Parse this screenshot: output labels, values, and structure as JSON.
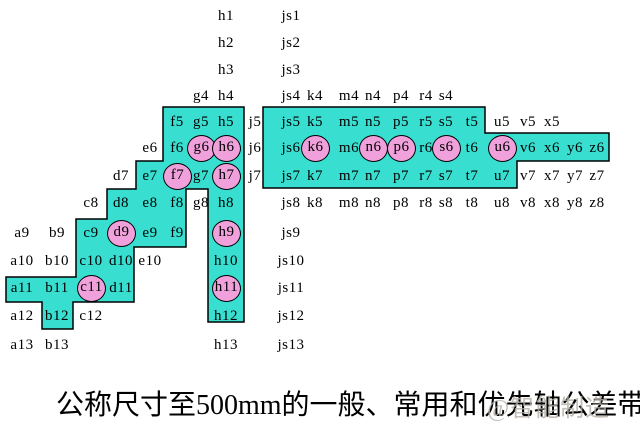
{
  "caption": {
    "text": "公称尺寸至500mm的一般、常用和优先轴公差带"
  },
  "watermark": {
    "text": "@智能制造"
  },
  "colors": {
    "background": "#ffffff",
    "common_fill": "#38dfd0",
    "preferred_fill": "#f0a0da",
    "outline": "#000000",
    "label_text": "#000000",
    "watermark_text": "#b3ada6"
  },
  "diagram": {
    "columns": [
      "a",
      "b",
      "c",
      "d",
      "e",
      "f",
      "g",
      "h",
      "j",
      "js",
      "k",
      "m",
      "n",
      "p",
      "r",
      "s",
      "t",
      "u",
      "v",
      "x",
      "y",
      "z"
    ],
    "row_grades": [
      1,
      2,
      3,
      4,
      5,
      6,
      7,
      8,
      9,
      10,
      11,
      12,
      13
    ],
    "status_legend": {
      "g": "general",
      "c": "common (cyan region)",
      "p": "preferred (circled)"
    },
    "cells": [
      [
        "h1",
        "h",
        1,
        "g"
      ],
      [
        "js1",
        "js",
        1,
        "g"
      ],
      [
        "h2",
        "h",
        2,
        "g"
      ],
      [
        "js2",
        "js",
        2,
        "g"
      ],
      [
        "h3",
        "h",
        3,
        "g"
      ],
      [
        "js3",
        "js",
        3,
        "g"
      ],
      [
        "g4",
        "g",
        4,
        "g"
      ],
      [
        "h4",
        "h",
        4,
        "g"
      ],
      [
        "js4",
        "js",
        4,
        "g"
      ],
      [
        "k4",
        "k",
        4,
        "g"
      ],
      [
        "m4",
        "m",
        4,
        "g"
      ],
      [
        "n4",
        "n",
        4,
        "g"
      ],
      [
        "p4",
        "p",
        4,
        "g"
      ],
      [
        "r4",
        "r",
        4,
        "g"
      ],
      [
        "s4",
        "s",
        4,
        "g"
      ],
      [
        "f5",
        "f",
        5,
        "c"
      ],
      [
        "g5",
        "g",
        5,
        "c"
      ],
      [
        "h5",
        "h",
        5,
        "c"
      ],
      [
        "j5",
        "j",
        5,
        "g"
      ],
      [
        "js5",
        "js",
        5,
        "c"
      ],
      [
        "k5",
        "k",
        5,
        "c"
      ],
      [
        "m5",
        "m",
        5,
        "c"
      ],
      [
        "n5",
        "n",
        5,
        "c"
      ],
      [
        "p5",
        "p",
        5,
        "c"
      ],
      [
        "r5",
        "r",
        5,
        "c"
      ],
      [
        "s5",
        "s",
        5,
        "c"
      ],
      [
        "t5",
        "t",
        5,
        "c"
      ],
      [
        "u5",
        "u",
        5,
        "g"
      ],
      [
        "v5",
        "v",
        5,
        "g"
      ],
      [
        "x5",
        "x",
        5,
        "g"
      ],
      [
        "e6",
        "e",
        6,
        "g"
      ],
      [
        "f6",
        "f",
        6,
        "c"
      ],
      [
        "g6",
        "g",
        6,
        "p"
      ],
      [
        "h6",
        "h",
        6,
        "p"
      ],
      [
        "j6",
        "j",
        6,
        "g"
      ],
      [
        "js6",
        "js",
        6,
        "c"
      ],
      [
        "k6",
        "k",
        6,
        "p"
      ],
      [
        "m6",
        "m",
        6,
        "c"
      ],
      [
        "n6",
        "n",
        6,
        "p"
      ],
      [
        "p6",
        "p",
        6,
        "p"
      ],
      [
        "r6",
        "r",
        6,
        "c"
      ],
      [
        "s6",
        "s",
        6,
        "p"
      ],
      [
        "t6",
        "t",
        6,
        "c"
      ],
      [
        "u6",
        "u",
        6,
        "p"
      ],
      [
        "v6",
        "v",
        6,
        "c"
      ],
      [
        "x6",
        "x",
        6,
        "c"
      ],
      [
        "y6",
        "y",
        6,
        "c"
      ],
      [
        "z6",
        "z",
        6,
        "c"
      ],
      [
        "d7",
        "d",
        7,
        "g"
      ],
      [
        "e7",
        "e",
        7,
        "c"
      ],
      [
        "f7",
        "f",
        7,
        "p"
      ],
      [
        "g7",
        "g",
        7,
        "c"
      ],
      [
        "h7",
        "h",
        7,
        "p"
      ],
      [
        "j7",
        "j",
        7,
        "g"
      ],
      [
        "js7",
        "js",
        7,
        "c"
      ],
      [
        "k7",
        "k",
        7,
        "c"
      ],
      [
        "m7",
        "m",
        7,
        "c"
      ],
      [
        "n7",
        "n",
        7,
        "c"
      ],
      [
        "p7",
        "p",
        7,
        "c"
      ],
      [
        "r7",
        "r",
        7,
        "c"
      ],
      [
        "s7",
        "s",
        7,
        "c"
      ],
      [
        "t7",
        "t",
        7,
        "c"
      ],
      [
        "u7",
        "u",
        7,
        "c"
      ],
      [
        "v7",
        "v",
        7,
        "g"
      ],
      [
        "x7",
        "x",
        7,
        "g"
      ],
      [
        "y7",
        "y",
        7,
        "g"
      ],
      [
        "z7",
        "z",
        7,
        "g"
      ],
      [
        "c8",
        "c",
        8,
        "g"
      ],
      [
        "d8",
        "d",
        8,
        "c"
      ],
      [
        "e8",
        "e",
        8,
        "c"
      ],
      [
        "f8",
        "f",
        8,
        "c"
      ],
      [
        "g8",
        "g",
        8,
        "g"
      ],
      [
        "h8",
        "h",
        8,
        "c"
      ],
      [
        "js8",
        "js",
        8,
        "g"
      ],
      [
        "k8",
        "k",
        8,
        "g"
      ],
      [
        "m8",
        "m",
        8,
        "g"
      ],
      [
        "n8",
        "n",
        8,
        "g"
      ],
      [
        "p8",
        "p",
        8,
        "g"
      ],
      [
        "r8",
        "r",
        8,
        "g"
      ],
      [
        "s8",
        "s",
        8,
        "g"
      ],
      [
        "t8",
        "t",
        8,
        "g"
      ],
      [
        "u8",
        "u",
        8,
        "g"
      ],
      [
        "v8",
        "v",
        8,
        "g"
      ],
      [
        "x8",
        "x",
        8,
        "g"
      ],
      [
        "y8",
        "y",
        8,
        "g"
      ],
      [
        "z8",
        "z",
        8,
        "g"
      ],
      [
        "a9",
        "a",
        9,
        "g"
      ],
      [
        "b9",
        "b",
        9,
        "g"
      ],
      [
        "c9",
        "c",
        9,
        "c"
      ],
      [
        "d9",
        "d",
        9,
        "p"
      ],
      [
        "e9",
        "e",
        9,
        "c"
      ],
      [
        "f9",
        "f",
        9,
        "c"
      ],
      [
        "h9",
        "h",
        9,
        "p"
      ],
      [
        "js9",
        "js",
        9,
        "g"
      ],
      [
        "a10",
        "a",
        10,
        "g"
      ],
      [
        "b10",
        "b",
        10,
        "g"
      ],
      [
        "c10",
        "c",
        10,
        "c"
      ],
      [
        "d10",
        "d",
        10,
        "c"
      ],
      [
        "e10",
        "e",
        10,
        "g"
      ],
      [
        "h10",
        "h",
        10,
        "c"
      ],
      [
        "js10",
        "js",
        10,
        "g"
      ],
      [
        "a11",
        "a",
        11,
        "c"
      ],
      [
        "b11",
        "b",
        11,
        "c"
      ],
      [
        "c11",
        "c",
        11,
        "p"
      ],
      [
        "d11",
        "d",
        11,
        "c"
      ],
      [
        "h11",
        "h",
        11,
        "p"
      ],
      [
        "js11",
        "js",
        11,
        "g"
      ],
      [
        "a12",
        "a",
        12,
        "g"
      ],
      [
        "b12",
        "b",
        12,
        "c"
      ],
      [
        "c12",
        "c",
        12,
        "g"
      ],
      [
        "h12",
        "h",
        12,
        "c"
      ],
      [
        "js12",
        "js",
        12,
        "g"
      ],
      [
        "a13",
        "a",
        13,
        "g"
      ],
      [
        "b13",
        "b",
        13,
        "g"
      ],
      [
        "h13",
        "h",
        13,
        "g"
      ],
      [
        "js13",
        "js",
        13,
        "g"
      ]
    ]
  }
}
